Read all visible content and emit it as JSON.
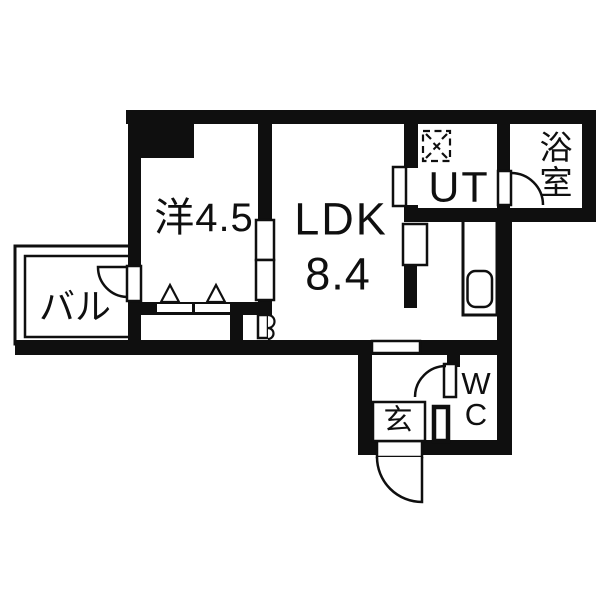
{
  "colors": {
    "wall": "#0f0f0f",
    "floor": "#ffffff"
  },
  "rooms": {
    "western": {
      "label": "洋4.5"
    },
    "ldk": {
      "label": "LDK",
      "size": "8.4"
    },
    "ut": {
      "label": "UT"
    },
    "bath": {
      "char1": "浴",
      "char2": "室"
    },
    "balcony": {
      "label": "バル"
    },
    "entrance": {
      "label": "玄"
    },
    "wc": {
      "char1": "W",
      "char2": "C"
    }
  },
  "symbols": {
    "washer_pan": "washing-machine-pan-icon",
    "door_types": "hinged-arc, sliding-panel, bifold"
  }
}
